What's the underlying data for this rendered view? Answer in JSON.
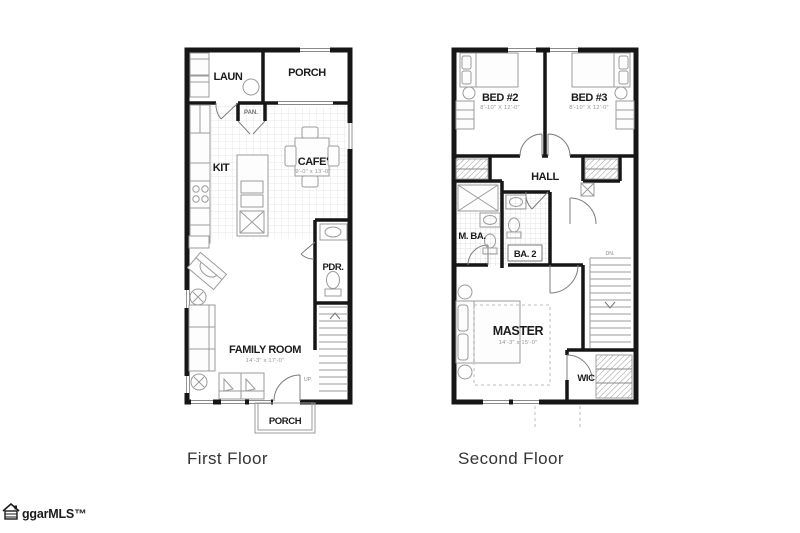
{
  "captions": {
    "first_floor": "First Floor",
    "second_floor": "Second Floor"
  },
  "logo": {
    "text": "ggarMLS™"
  },
  "first_floor": {
    "laun": "LAUN",
    "porch_top": "PORCH",
    "pan": "PAN.",
    "kit": "KIT",
    "cafe": "CAFE'",
    "cafe_dims": "9'-0\" x 13'-0\"",
    "pdr": "PDR.",
    "family_room": "FAMILY ROOM",
    "family_room_dims": "14'-3\" x 17'-0\"",
    "up": "UP.",
    "porch_bottom": "PORCH"
  },
  "second_floor": {
    "bed2": "BED #2",
    "bed2_dims": "8'-10\" X 12'-0\"",
    "bed3": "BED #3",
    "bed3_dims": "8'-10\" X 12'-0\"",
    "hall": "HALL",
    "master_bath": "M. BA.",
    "bath2": "BA. 2",
    "dn": "DN.",
    "master": "MASTER",
    "master_dims": "14'-3\" x 15'-0\"",
    "wic": "WIC"
  }
}
